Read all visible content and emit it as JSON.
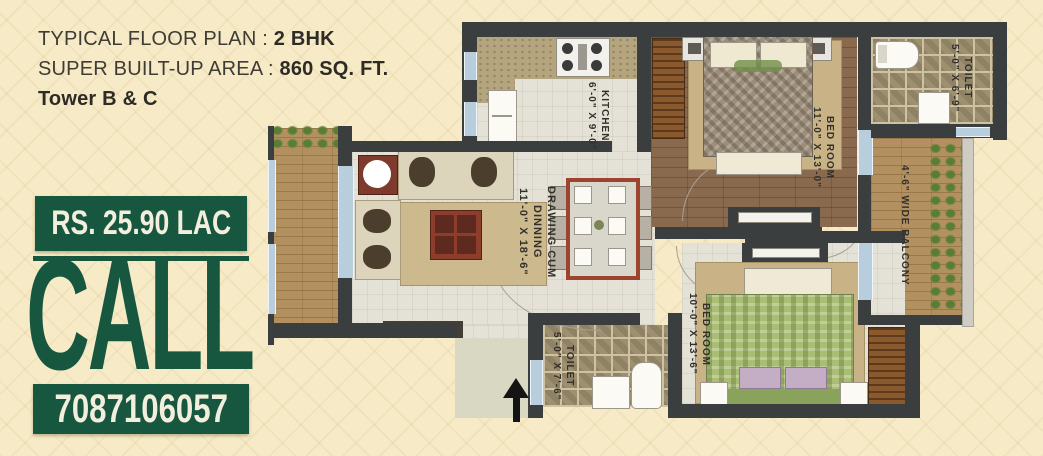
{
  "header": {
    "line1_label": "TYPICAL FLOOR PLAN :",
    "line1_value": "2 BHK",
    "line2_label": "SUPER BUILT-UP AREA :",
    "line2_value": "860 SQ. FT.",
    "line3": "Tower B & C"
  },
  "promo": {
    "price": "RS. 25.90 LAC",
    "call_label": "CALL",
    "phone": "7087106057"
  },
  "plan": {
    "rooms": {
      "kitchen": {
        "name": "KITCHEN",
        "dims": "6'-0\" X 9'-0\""
      },
      "bedroom1": {
        "name": "BED ROOM",
        "dims": "11'-0\" X 13'-0\""
      },
      "toilet1": {
        "name": "TOILET",
        "dims": "5'-0\" X 6'-9\""
      },
      "balcony": {
        "name": "4'-6\" WIDE BALCONY"
      },
      "drawing": {
        "name_line1": "DRAWING CUM",
        "name_line2": "DINNING",
        "dims": "11'-0\" X 18'-6\""
      },
      "bedroom2": {
        "name": "BED ROOM",
        "dims": "10'-0\" X 13'-6\""
      },
      "toilet2": {
        "name": "TOILET",
        "dims": "5'-0\" X 7'-6\""
      }
    },
    "entry_arrow": "entry direction up"
  },
  "colors": {
    "accent_green": "#17573f",
    "background_cream": "#f6ebc6",
    "wall_dark": "#3b3e3e",
    "window_blue": "#b9cedc"
  }
}
